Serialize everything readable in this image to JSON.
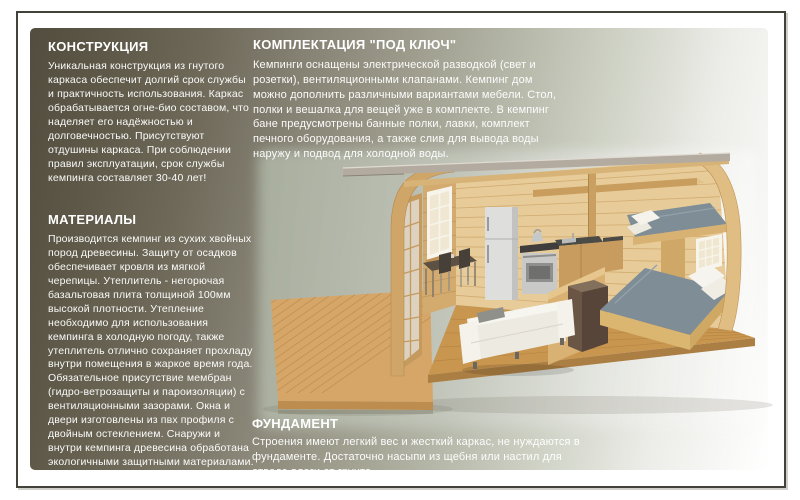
{
  "page": {
    "kind": "camping house brochure page",
    "language": "ru",
    "background_color": "#ffffff",
    "frame_color": "#43423a",
    "panel_gradient_from": "#524d3e",
    "panel_gradient_mid": "#b2b4a5",
    "panel_gradient_to": "#ffffff",
    "text_color": "#ffffff"
  },
  "sections": {
    "construction": {
      "title": "КОНСТРУКЦИЯ",
      "body": "Уникальная конструкция из гнутого каркаса обеспечит долгий срок службы и практичность использования. Каркас обрабатывается огне-био составом, что наделяет его надёжностью и долговечностью. Присутствуют отдушины каркаса. При соблюдении правил эксплуатации, срок службы кемпинга составляет 30-40 лет!"
    },
    "materials": {
      "title": "МАТЕРИАЛЫ",
      "body": "Производится кемпинг из сухих хвойных пород древесины. Защиту от осадков обеспечивает кровля из мягкой черепицы. Утеплитель - негорючая базальтовая плита толщиной 100мм высокой плотности. Утепление необходимо для использования кемпинга в холодную погоду, также утеплитель отлично сохраняет прохладу внутри помещения в жаркое время года. Обязательное присутствие мембран (гидро-ветрозащиты и пароизоляции) с вентиляционными зазорами. Окна и двери изготовлены из пвх профиля с двойным остеклением. Снаружи и внутри кемпинга древесина обработана экологичными защитными материалами."
    },
    "turnkey": {
      "title": "КОМПЛЕКТАЦИЯ \"ПОД КЛЮЧ\"",
      "body": "Кемпинги оснащены электрической разводкой (свет и розетки), вентиляционными клапанами. Кемпинг дом можно дополнить различными вариантами мебели. Стол, полки и вешалка для вещей уже в комплекте. В кемпинг бане предусмотрены банные полки, лавки, комплект печного оборудования, а также слив для вывода воды наружу и подвод для холодной воды."
    },
    "foundation": {
      "title": "ФУНДАМЕНТ",
      "body": "Строения имеют легкий вес и жесткий каркас, не нуждаются в фундаменте. Достаточно насыпи из щебня или настил для отвода влаги от грунта."
    }
  },
  "illustration": {
    "name": "camping-house-cutaway",
    "alt": "3D cutaway render of an arched (barrel) wooden camping house interior with kitchen, dining table, sofa, double bed, loft bunk bed and front terrace deck",
    "palette": {
      "backdrop_sage": "#a9aea0",
      "wood_wall": "#e7cb98",
      "wood_floor": "#c9964f",
      "wood_deck": "#d6a668",
      "roof_fascia": "#b3aba0",
      "mattress_gray": "#7f8d96",
      "sofa_white": "#efece4",
      "counter_dark": "#4a4a46",
      "wardrobe_brown": "#6b5645",
      "appliance_silver": "#d8d8d6"
    }
  }
}
